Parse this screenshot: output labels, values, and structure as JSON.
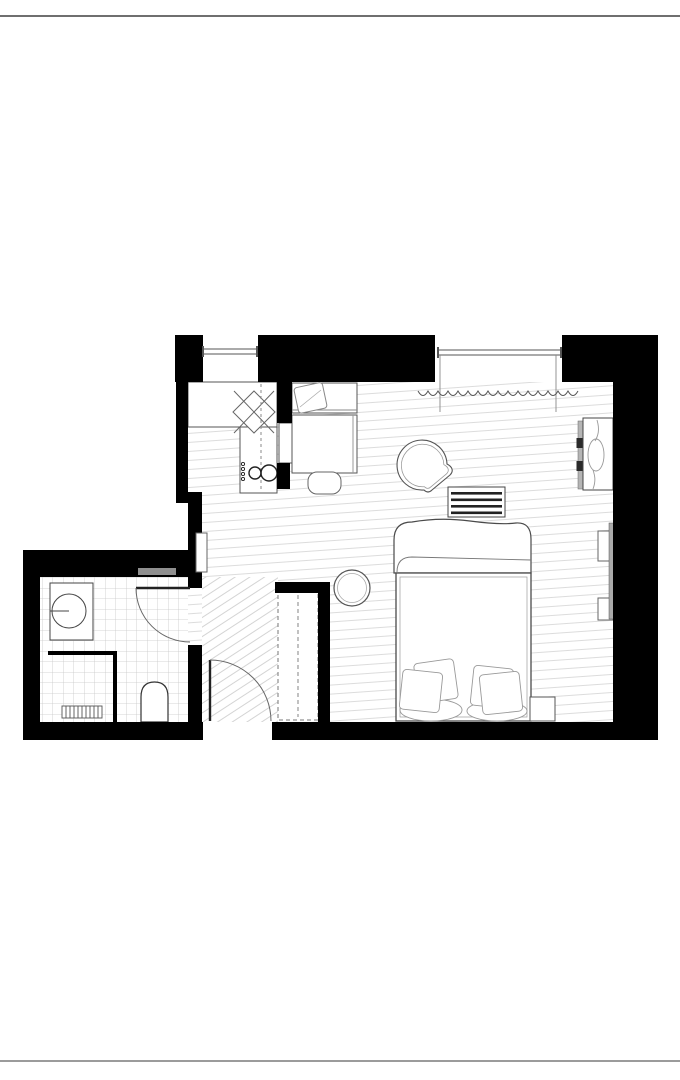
{
  "page": {
    "width": 680,
    "height": 1080,
    "background": "#ffffff",
    "top_rule_color": "#6f6f6f",
    "bottom_rule_color": "#9b9b9b"
  },
  "plan": {
    "type": "studio-apartment-floor-plan",
    "colors": {
      "walls": "#000000",
      "furniture_line": "#4a4a4a",
      "light_line": "#8a8a8a",
      "floor_hatch": "#dcdcdc",
      "hall_hatch": "#d4d4d4",
      "tile_grid": "#c8c8c8",
      "panel_gray": "#aaaaaa",
      "niche_gray": "#8f8f8f"
    },
    "labels": {
      "plan": "studio-apartment-floor-plan",
      "main_room": "main-room-floor",
      "hall": "hallway-floor",
      "bathroom_floor": "bathroom-tile-floor",
      "walls": "walls",
      "window_left": "window",
      "window_right": "window",
      "curtain": "curtain",
      "kitchen_counter": "kitchen-counter",
      "prep_table": "prep-table",
      "cooktop": "cooktop-sink-unit",
      "appliance": "appliance-cabinet",
      "bench": "dining-bench",
      "bench_pillow": "bench-pillow",
      "table": "dining-table",
      "chair": "dining-chair",
      "armchair": "armchair",
      "radiator_bench": "radiator",
      "bed": "double-bed",
      "duvet": "duvet-roll",
      "pillows_left": "bed-pillows",
      "pillows_right": "bed-pillows",
      "shelf_upper": "wall-shelf",
      "shelf_lower": "wall-shelf",
      "wall_panel": "wall-panel",
      "designer_radiator": "designer-radiator",
      "stool": "bedside-stool",
      "wardrobe": "wardrobe",
      "side_table": "round-side-table",
      "washbasin": "washbasin",
      "toilet": "toilet",
      "shower": "shower-enclosure",
      "drain": "shower-drain-grate",
      "bathroom_door": "bathroom-door",
      "entry_door": "entry-door",
      "niche": "wall-niche",
      "duct": "duct-chase",
      "top_rule": "page-top-rule",
      "bottom_rule": "page-bottom-rule"
    }
  }
}
